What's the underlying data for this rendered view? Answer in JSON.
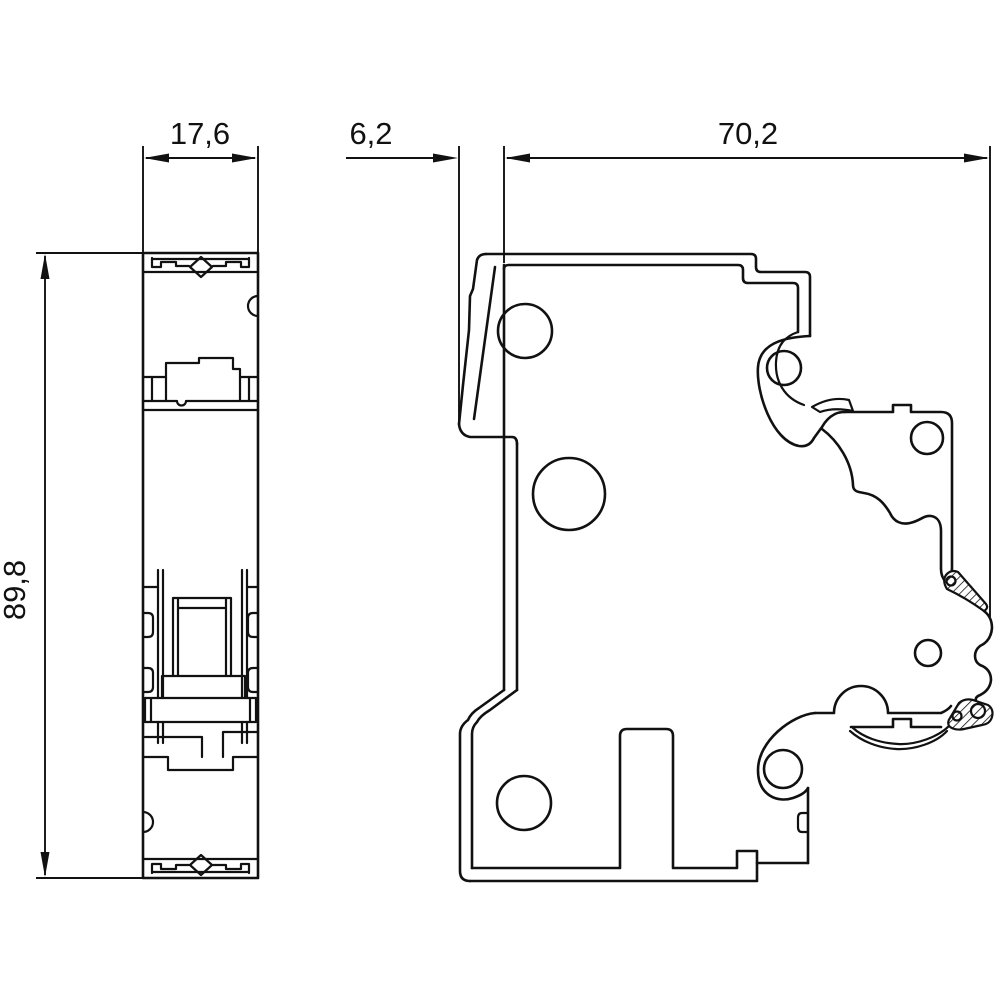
{
  "drawing": {
    "title": "Miniature circuit breaker — dimensional drawing",
    "views": {
      "front_view": "front view (narrow face with DIN clips, toggle and terminals)",
      "side_view": "side view (housing profile with toggle lever and DIN-rail clip)"
    },
    "line_color": "#111111",
    "background_color": "#ffffff",
    "unit_style": "millimetres, decimal comma"
  },
  "dimensions": {
    "width": {
      "label": "17,6",
      "value_mm": 17.6,
      "orientation": "horizontal",
      "measures": "overall width of front view"
    },
    "lever": {
      "label": "6,2",
      "value_mm": 6.2,
      "orientation": "horizontal",
      "measures": "toggle lever projection beyond housing front face"
    },
    "depth": {
      "label": "70,2",
      "value_mm": 70.2,
      "orientation": "horizontal",
      "measures": "overall depth of side view"
    },
    "height": {
      "label": "89,8",
      "value_mm": 89.8,
      "orientation": "vertical",
      "measures": "overall height of housing"
    }
  }
}
